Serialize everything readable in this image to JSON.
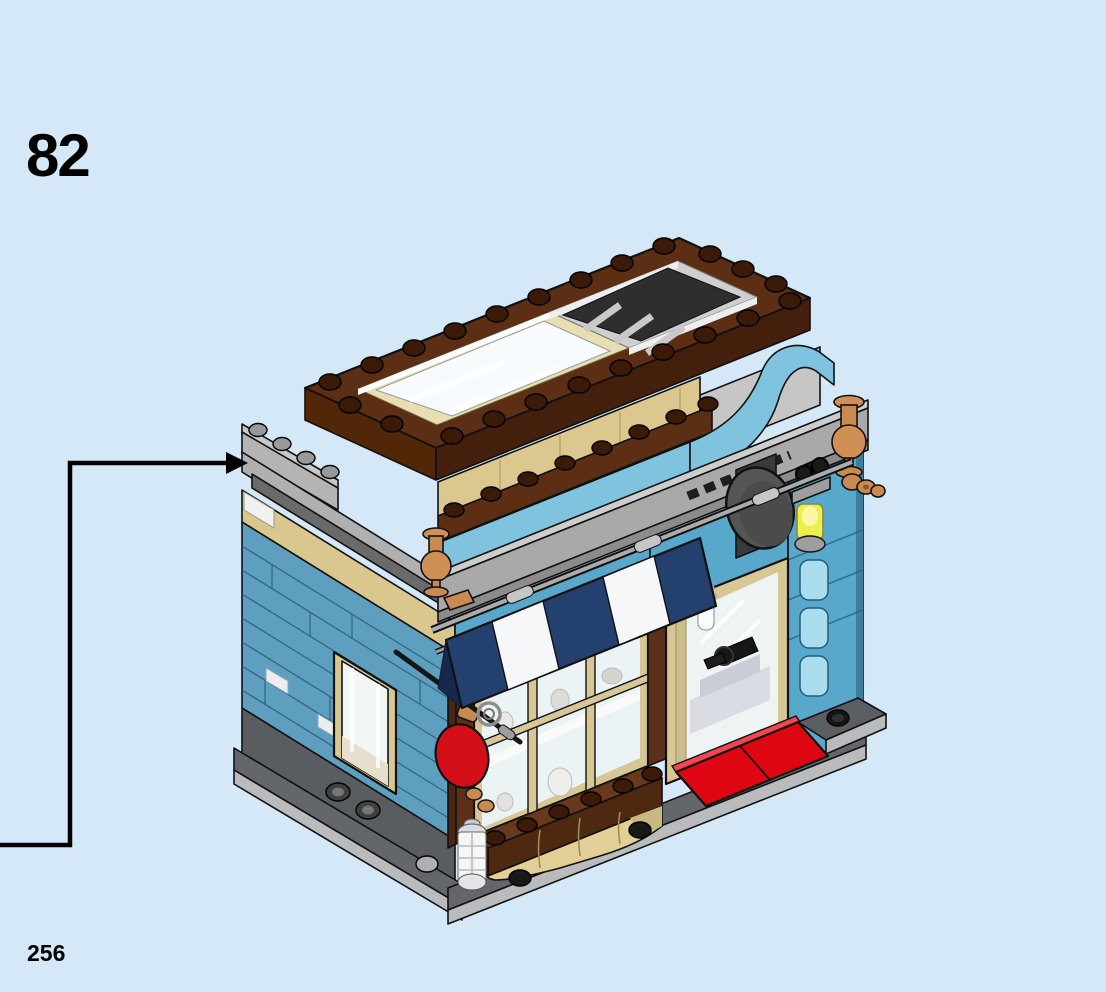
{
  "page": {
    "background": "#d4e8f7",
    "step_number": "82",
    "page_number": "256"
  },
  "callout": {
    "type": "elbow-arrow",
    "color": "#000000",
    "points": "0,845 70,845 70,463 226,463",
    "arrow_tip": "248,463",
    "target": "top-left cornice plates of the model"
  },
  "model": {
    "description": "LEGO Creator toy-shop corner building, isometric instruction render",
    "colors": {
      "roof_brown": "#5c2e14",
      "roof_brown_dark": "#44200c",
      "tan_trim": "#dcc88e",
      "wall_blue_left": "#5e9fc0",
      "wall_blue_right": "#58a8cc",
      "azure_trim": "#7fc3de",
      "panel_azure": "#a9dced",
      "awning_blue": "#24406f",
      "awning_white": "#f5f7f8",
      "sign_red": "#d50f19",
      "carpet_red": "#df0613",
      "copper": "#c98a50",
      "gray_light": "#b9bbbd",
      "gray_mid": "#a9a9a9",
      "gray_dark": "#63666b",
      "trans_yellow": "#edef4d",
      "glass": "#eef4f3",
      "black_parts": "#161616"
    },
    "parts": [
      {
        "name": "roof-rim",
        "color": "#5c2e14"
      },
      {
        "name": "roof-skylight",
        "color": "#f7fbfe"
      },
      {
        "name": "roof-vent-grille",
        "color": "#2e2e2e"
      },
      {
        "name": "cornice-plates",
        "color": "#b0b0b0"
      },
      {
        "name": "tan-fascia",
        "color": "#dcc88e"
      },
      {
        "name": "azure-arch-trim",
        "color": "#7fc3de"
      },
      {
        "name": "gray-beam",
        "color": "#a9a9a9"
      },
      {
        "name": "round-sign-disc",
        "color": "#555555"
      },
      {
        "name": "binoculars-piece",
        "color": "#191919"
      },
      {
        "name": "corner-goblet-left",
        "color": "#c98a50"
      },
      {
        "name": "corner-goblet-right",
        "color": "#c98a50"
      },
      {
        "name": "copper-rings",
        "color": "#c98a50"
      },
      {
        "name": "striped-awning",
        "color": "#24406f"
      },
      {
        "name": "awning-rails",
        "color": "#ababab"
      },
      {
        "name": "shop-window",
        "color": "#d6c795"
      },
      {
        "name": "window-shelves",
        "color": "#fafafa"
      },
      {
        "name": "brown-pillars",
        "color": "#5d3119"
      },
      {
        "name": "red-round-sign",
        "color": "#d50f19"
      },
      {
        "name": "fishing-rod",
        "color": "#161616"
      },
      {
        "name": "window-sill-ledge",
        "color": "#69391c"
      },
      {
        "name": "curved-bay-base",
        "color": "#e2d096"
      },
      {
        "name": "white-corner-lantern",
        "color": "#f4f6f7"
      },
      {
        "name": "yellow-corner-lamp",
        "color": "#edef4d"
      },
      {
        "name": "glass-door",
        "color": "#eef4f3"
      },
      {
        "name": "milk-bottle",
        "color": "#fbfbfb"
      },
      {
        "name": "camera-piece",
        "color": "#161616"
      },
      {
        "name": "red-carpet-steps",
        "color": "#df0613"
      },
      {
        "name": "side-window",
        "color": "#f2f7f6"
      },
      {
        "name": "porthole-tiles",
        "color": "#3f4143"
      },
      {
        "name": "base-plates",
        "color": "#63666b"
      }
    ]
  }
}
